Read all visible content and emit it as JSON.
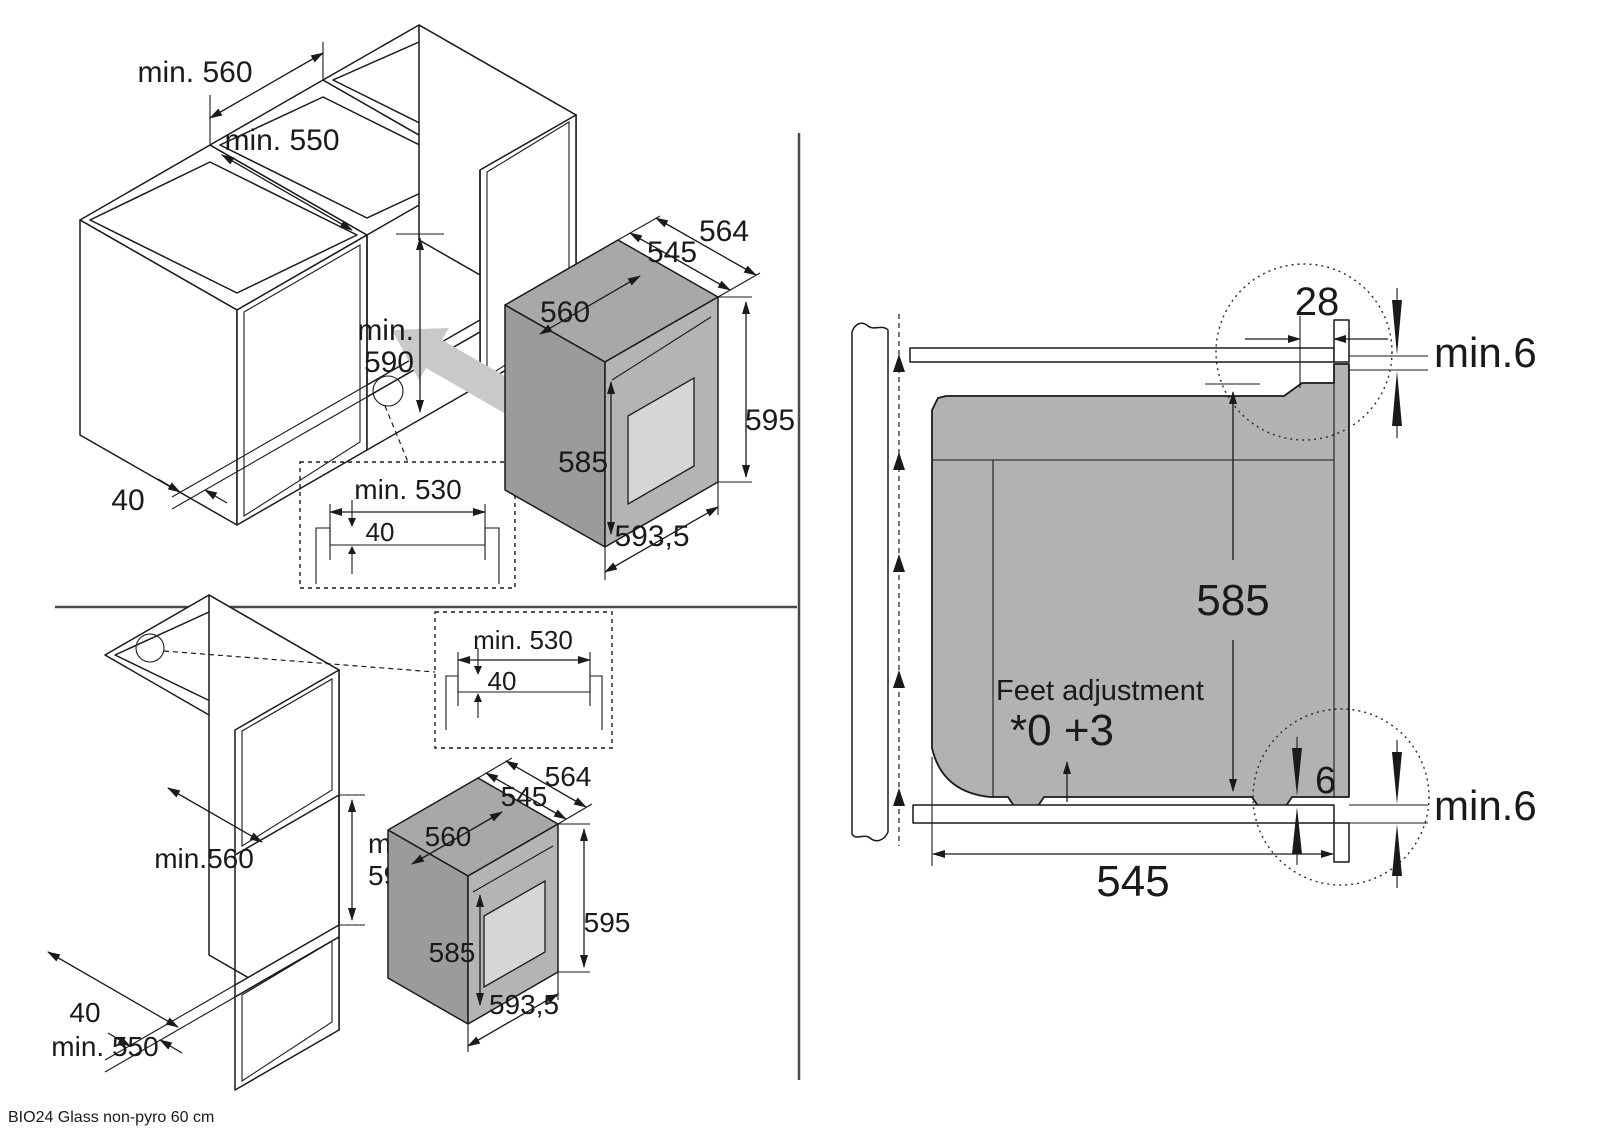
{
  "footer": {
    "model": "BIO24 Glass non-pyro 60 cm"
  },
  "colors": {
    "line": "#1a1a1a",
    "oven_gray": "#b2b2b2",
    "oven_front_gray": "#b4b4b4",
    "window_gray": "#d6d6d6",
    "insert_arrow_gray": "#c9c9c9",
    "background": "#ffffff"
  },
  "top_left": {
    "niche_width": "min. 560",
    "niche_depth": "min. 550",
    "niche_height_1": "min.",
    "niche_height_2": "590",
    "rail_width": "40",
    "inset": {
      "width": "min. 530",
      "depth": "40"
    },
    "oven": {
      "depth_overall": "564",
      "depth_body": "545",
      "top_width": "560",
      "side_height": "585",
      "front_height": "595",
      "front_width": "593,5"
    }
  },
  "bottom_left": {
    "niche_height_1": "min.",
    "niche_height_2": "590",
    "niche_depth": "min.560",
    "rail_width": "40",
    "base_depth": "min. 550",
    "inset": {
      "width": "min. 530",
      "depth": "40"
    },
    "oven": {
      "depth_overall": "564",
      "depth_body": "545",
      "top_width": "560",
      "side_height": "585",
      "front_height": "595",
      "front_width": "593,5"
    }
  },
  "right": {
    "frame_overhang": "28",
    "top_clearance": "min.6",
    "body_height": "585",
    "feet_title": "Feet adjustment",
    "feet_range": "*0 +3",
    "bottom_gap": "6",
    "bottom_clearance": "min.6",
    "body_depth": "545"
  }
}
